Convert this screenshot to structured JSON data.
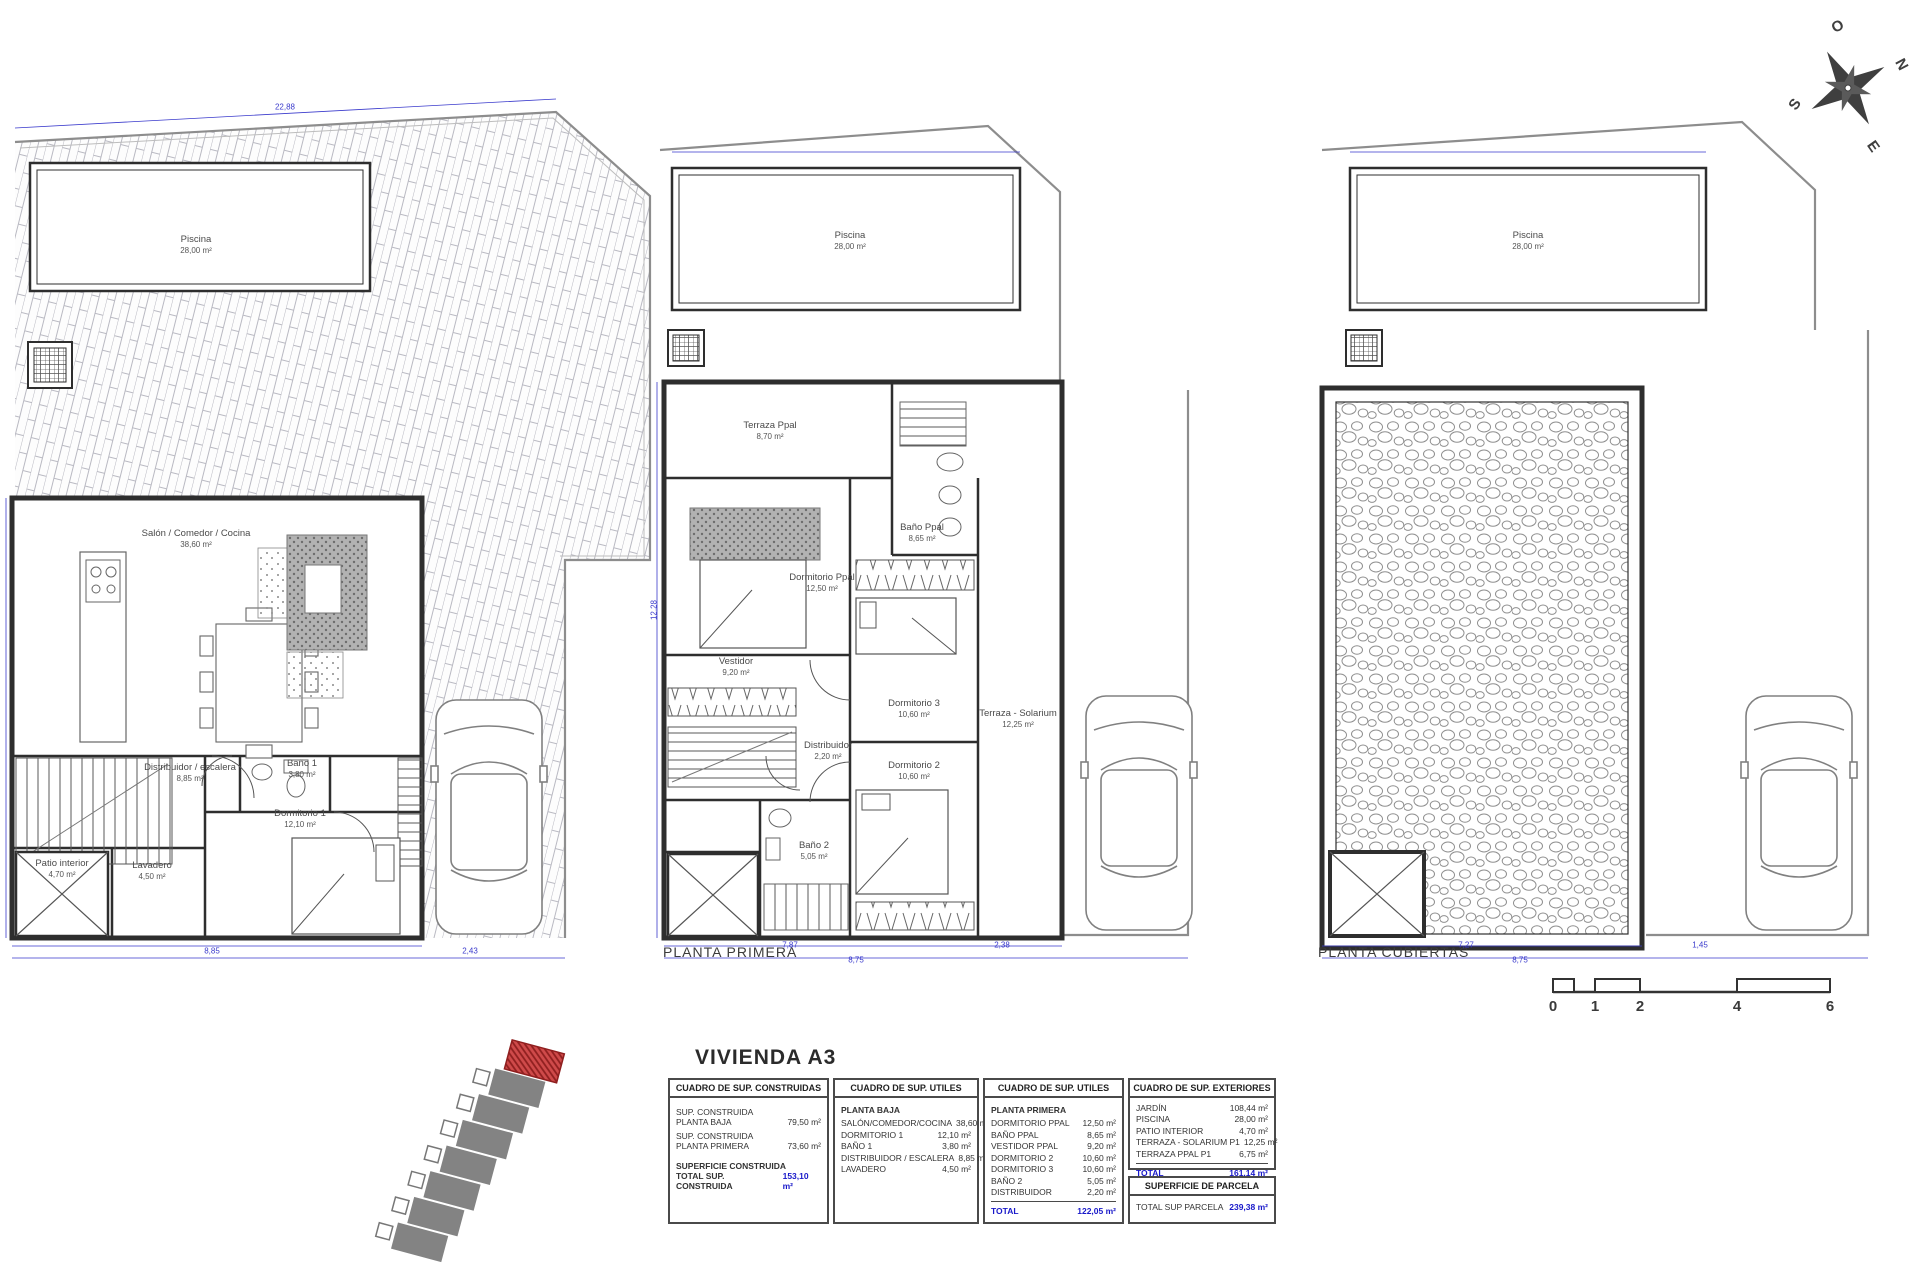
{
  "sheet": {
    "title": "VIVIENDA A3"
  },
  "compass": {
    "o": "O",
    "n": "N",
    "s": "S",
    "e": "E"
  },
  "plans": {
    "baja": {
      "rooms": {
        "piscina": {
          "name": "Piscina",
          "area": "28,00 m²"
        },
        "salon": {
          "name": "Salón / Comedor / Cocina",
          "area": "38,60 m²"
        },
        "distribuidor": {
          "name": "Distribuidor / escalera",
          "area": "8,85 m²"
        },
        "bano1": {
          "name": "Baño 1",
          "area": "3,80 m²"
        },
        "dormitorio1": {
          "name": "Dormitorio 1",
          "area": "12,10 m²"
        },
        "lavadero": {
          "name": "Lavadero",
          "area": "4,50 m²"
        },
        "patio": {
          "name": "Patio interior",
          "area": "4,70 m²"
        }
      }
    },
    "primera": {
      "title": "PLANTA PRIMERA",
      "rooms": {
        "piscina": {
          "name": "Piscina",
          "area": "28,00 m²"
        },
        "terraza_ppal": {
          "name": "Terraza Ppal",
          "area": "8,70 m²"
        },
        "bano_ppal": {
          "name": "Baño Ppal",
          "area": "8,65 m²"
        },
        "dormitorio_ppal": {
          "name": "Dormitorio Ppal",
          "area": "12,50 m²"
        },
        "vestidor": {
          "name": "Vestidor",
          "area": "9,20 m²"
        },
        "distribuidor": {
          "name": "Distribuidor",
          "area": "2,20 m²"
        },
        "dormitorio3": {
          "name": "Dormitorio 3",
          "area": "10,60 m²"
        },
        "dormitorio2": {
          "name": "Dormitorio 2",
          "area": "10,60 m²"
        },
        "bano2": {
          "name": "Baño 2",
          "area": "5,05 m²"
        },
        "solarium": {
          "name": "Terraza - Solarium",
          "area": "12,25 m²"
        }
      }
    },
    "cubiertas": {
      "title": "PLANTA CUBIERTAS",
      "rooms": {
        "piscina": {
          "name": "Piscina",
          "area": "28,00 m²"
        }
      }
    }
  },
  "dims": {
    "baja_top": "22,88",
    "baja_w": "8,85",
    "baja_w2": "2,43",
    "primera_w": "7,87",
    "primera_w2": "8,75",
    "primera_w3": "2,38",
    "primera_h": "12,28",
    "cubiertas_w": "7,27",
    "cubiertas_w2": "8,75",
    "cubiertas_w3": "1,45"
  },
  "scale_bar": {
    "ticks": [
      "0",
      "1",
      "2",
      "4",
      "6"
    ]
  },
  "tables": {
    "construida": {
      "header": "CUADRO DE SUP. CONSTRUIDAS",
      "rows": [
        {
          "l1": "SUP. CONSTRUIDA",
          "l2": "PLANTA BAJA",
          "v": "79,50 m²"
        },
        {
          "l1": "SUP. CONSTRUIDA",
          "l2": "PLANTA PRIMERA",
          "v": "73,60 m²"
        }
      ],
      "footer_label": "SUPERFICIE CONSTRUIDA",
      "total_label": "TOTAL SUP. CONSTRUIDA",
      "total_value": "153,10 m²"
    },
    "utiles_baja": {
      "header": "CUADRO DE SUP. UTILES",
      "section": "PLANTA BAJA",
      "rows": [
        {
          "label": "SALÓN/COMEDOR/COCINA",
          "v": "38,60 m²"
        },
        {
          "label": "DORMITORIO 1",
          "v": "12,10 m²"
        },
        {
          "label": "BAÑO 1",
          "v": "3,80 m²"
        },
        {
          "label": "DISTRIBUIDOR / ESCALERA",
          "v": "8,85 m²"
        },
        {
          "label": "LAVADERO",
          "v": "4,50 m²"
        }
      ]
    },
    "utiles_primera": {
      "header": "CUADRO DE SUP. UTILES",
      "section": "PLANTA PRIMERA",
      "rows": [
        {
          "label": "DORMITORIO PPAL",
          "v": "12,50 m²"
        },
        {
          "label": "BAÑO PPAL",
          "v": "8,65 m²"
        },
        {
          "label": "VESTIDOR PPAL",
          "v": "9,20 m²"
        },
        {
          "label": "DORMITORIO 2",
          "v": "10,60 m²"
        },
        {
          "label": "DORMITORIO 3",
          "v": "10,60 m²"
        },
        {
          "label": "BAÑO 2",
          "v": "5,05 m²"
        },
        {
          "label": "DISTRIBUIDOR",
          "v": "2,20 m²"
        }
      ],
      "total_label": "TOTAL",
      "total_value": "122,05 m²"
    },
    "exteriores": {
      "header": "CUADRO DE SUP. EXTERIORES",
      "rows": [
        {
          "label": "JARDÍN",
          "v": "108,44 m²"
        },
        {
          "label": "PISCINA",
          "v": "28,00 m²"
        },
        {
          "label": "PATIO INTERIOR",
          "v": "4,70 m²"
        },
        {
          "label": "TERRAZA - SOLARIUM P1",
          "v": "12,25 m²"
        },
        {
          "label": "TERRAZA PPAL P1",
          "v": "6,75 m²"
        }
      ],
      "total_label": "TOTAL",
      "total_value": "161,14 m²"
    },
    "parcela": {
      "header": "SUPERFICIE DE PARCELA",
      "row_label": "TOTAL SUP PARCELA",
      "row_value": "239,38 m²"
    }
  },
  "colors": {
    "dim_blue": "#3a3acc",
    "wall": "#2e2e2e",
    "highlight_red": "#cf4a4a",
    "total_blue": "#1717c9"
  }
}
